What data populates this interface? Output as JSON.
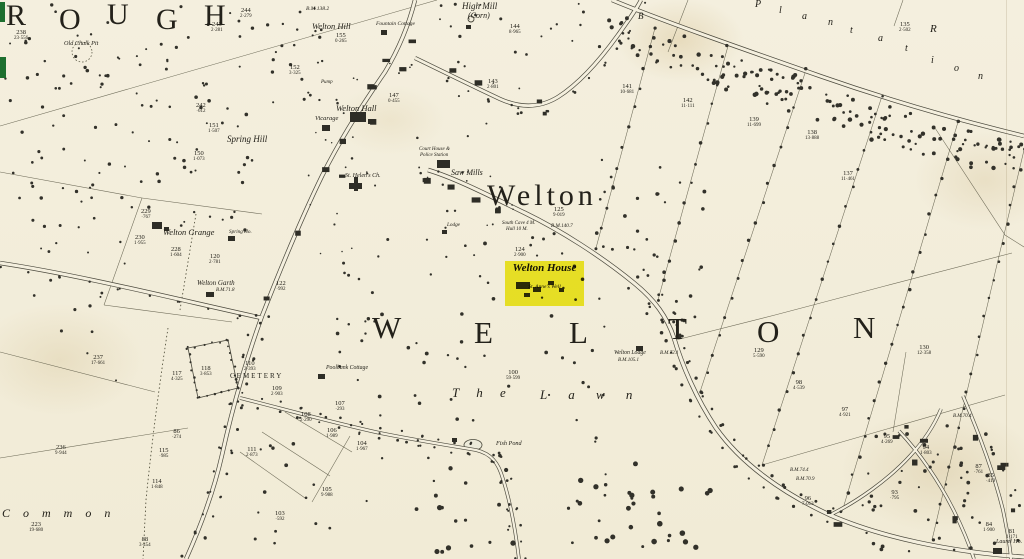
{
  "map": {
    "colors": {
      "paper": "#f4efde",
      "ink": "#4a483c",
      "text": "#23211a",
      "highlight": "#f2ef2b",
      "green_mark": "#1d6f2f"
    },
    "highlight": {
      "title": "Welton House",
      "subtitle": "St. Anne's Well"
    },
    "labels": [
      {
        "t": "R",
        "x": 6,
        "y": 1,
        "fs": 30
      },
      {
        "t": "O",
        "x": 59,
        "y": 5,
        "fs": 30
      },
      {
        "t": "U",
        "x": 107,
        "y": 0,
        "fs": 30
      },
      {
        "t": "G",
        "x": 156,
        "y": 5,
        "fs": 30
      },
      {
        "t": "H",
        "x": 204,
        "y": 1,
        "fs": 30
      },
      {
        "t": "Welton",
        "x": 487,
        "y": 181,
        "fs": 30,
        "ls": 4
      },
      {
        "t": "W",
        "x": 372,
        "y": 312,
        "fs": 31
      },
      {
        "t": "E",
        "x": 474,
        "y": 317,
        "fs": 31
      },
      {
        "t": "L",
        "x": 569,
        "y": 317,
        "fs": 31
      },
      {
        "t": "T",
        "x": 668,
        "y": 313,
        "fs": 31
      },
      {
        "t": "O",
        "x": 757,
        "y": 316,
        "fs": 31
      },
      {
        "t": "N",
        "x": 853,
        "y": 312,
        "fs": 31
      },
      {
        "t": "T h e",
        "x": 452,
        "y": 386,
        "fs": 13,
        "it": 1,
        "ls": 7
      },
      {
        "t": "L a w n",
        "x": 540,
        "y": 388,
        "fs": 13,
        "it": 1,
        "ls": 9
      },
      {
        "t": "C o m m o n",
        "x": 2,
        "y": 507,
        "fs": 12,
        "it": 1,
        "ls": 5
      },
      {
        "t": "P",
        "x": 755,
        "y": 0,
        "fs": 10,
        "it": 1
      },
      {
        "t": "l",
        "x": 779,
        "y": 6,
        "fs": 10,
        "it": 1
      },
      {
        "t": "a",
        "x": 802,
        "y": 12,
        "fs": 10,
        "it": 1
      },
      {
        "t": "n",
        "x": 828,
        "y": 18,
        "fs": 10,
        "it": 1
      },
      {
        "t": "t",
        "x": 850,
        "y": 26,
        "fs": 10,
        "it": 1
      },
      {
        "t": "a",
        "x": 878,
        "y": 34,
        "fs": 10,
        "it": 1
      },
      {
        "t": "t",
        "x": 905,
        "y": 44,
        "fs": 10,
        "it": 1
      },
      {
        "t": "i",
        "x": 931,
        "y": 56,
        "fs": 10,
        "it": 1
      },
      {
        "t": "o",
        "x": 954,
        "y": 64,
        "fs": 10,
        "it": 1
      },
      {
        "t": "n",
        "x": 978,
        "y": 72,
        "fs": 10,
        "it": 1
      },
      {
        "t": "B",
        "x": 638,
        "y": 12,
        "fs": 9,
        "it": 1
      },
      {
        "t": "R",
        "x": 930,
        "y": 24,
        "fs": 11,
        "it": 1
      },
      {
        "t": "High Mill",
        "x": 462,
        "y": 2,
        "fs": 9,
        "it": 1
      },
      {
        "t": "(Corn)",
        "x": 468,
        "y": 12,
        "fs": 8,
        "it": 1
      },
      {
        "t": "Fountain Cottage",
        "x": 376,
        "y": 22,
        "fs": 5.5,
        "it": 1
      },
      {
        "t": "Welton Hill",
        "x": 312,
        "y": 22,
        "fs": 8.5,
        "it": 1
      },
      {
        "t": "B.M.138.2",
        "x": 306,
        "y": 7,
        "fs": 5.5,
        "it": 1
      },
      {
        "t": "Welton Hall",
        "x": 336,
        "y": 104,
        "fs": 8.5,
        "it": 1
      },
      {
        "t": "Vicarage",
        "x": 315,
        "y": 116,
        "fs": 6.5,
        "it": 1
      },
      {
        "t": "Spring Hill",
        "x": 227,
        "y": 135,
        "fs": 9,
        "it": 1
      },
      {
        "t": "Pump",
        "x": 321,
        "y": 80,
        "fs": 5,
        "it": 1
      },
      {
        "t": "Saw Mills",
        "x": 451,
        "y": 169,
        "fs": 8,
        "it": 1
      },
      {
        "t": "St. Helen's Ch.",
        "x": 345,
        "y": 173,
        "fs": 6,
        "it": 1
      },
      {
        "t": "Court House &",
        "x": 419,
        "y": 147,
        "fs": 5,
        "it": 1
      },
      {
        "t": "Police Station",
        "x": 420,
        "y": 153,
        "fs": 5,
        "it": 1
      },
      {
        "t": "Welton Grange",
        "x": 163,
        "y": 228,
        "fs": 8.5,
        "it": 1
      },
      {
        "t": "Spring Ho.",
        "x": 229,
        "y": 230,
        "fs": 5.2,
        "it": 1
      },
      {
        "t": "Welton Garth",
        "x": 197,
        "y": 280,
        "fs": 7,
        "it": 1
      },
      {
        "t": "B.M.71.8",
        "x": 216,
        "y": 288,
        "fs": 5,
        "it": 1
      },
      {
        "t": "CEMETERY",
        "x": 230,
        "y": 373,
        "fs": 7,
        "ls": 2
      },
      {
        "t": "Poolbank Cottage",
        "x": 326,
        "y": 366,
        "fs": 5.8,
        "it": 1
      },
      {
        "t": "Fish Pond",
        "x": 496,
        "y": 441,
        "fs": 6.2,
        "it": 1
      },
      {
        "t": "Welton Lodge",
        "x": 614,
        "y": 351,
        "fs": 5.8,
        "it": 1
      },
      {
        "t": "B.M.105.1",
        "x": 618,
        "y": 358,
        "fs": 5,
        "it": 1
      },
      {
        "t": "Old Chalk Pit",
        "x": 64,
        "y": 41,
        "fs": 6.2,
        "it": 1
      },
      {
        "t": "South Cave 4 M.",
        "x": 502,
        "y": 221,
        "fs": 5,
        "it": 1
      },
      {
        "t": "Hull 10 M.",
        "x": 506,
        "y": 227,
        "fs": 5,
        "it": 1
      },
      {
        "t": "B.M.140.7",
        "x": 551,
        "y": 224,
        "fs": 5.2,
        "it": 1
      },
      {
        "t": "B.M.72.1",
        "x": 660,
        "y": 351,
        "fs": 5,
        "it": 1
      },
      {
        "t": "B.M.74.4",
        "x": 790,
        "y": 468,
        "fs": 5,
        "it": 1
      },
      {
        "t": "B.M.70.9",
        "x": 796,
        "y": 477,
        "fs": 5,
        "it": 1
      },
      {
        "t": "B.M.70.4",
        "x": 953,
        "y": 414,
        "fs": 5,
        "it": 1
      },
      {
        "t": "Laurel Ho.",
        "x": 996,
        "y": 539,
        "fs": 6,
        "it": 1
      },
      {
        "t": "Lodge",
        "x": 447,
        "y": 223,
        "fs": 5.2,
        "it": 1
      }
    ],
    "parcel_numbers": [
      {
        "n": "238",
        "a": "23·556",
        "x": 14,
        "y": 29
      },
      {
        "n": "244",
        "a": "2·279",
        "x": 240,
        "y": 7
      },
      {
        "n": "243",
        "a": "2·281",
        "x": 211,
        "y": 21
      },
      {
        "n": "242",
        "a": "·612",
        "x": 196,
        "y": 102
      },
      {
        "n": "151",
        "a": "1·507",
        "x": 208,
        "y": 122
      },
      {
        "n": "150",
        "a": "1·073",
        "x": 193,
        "y": 150
      },
      {
        "n": "155",
        "a": "0·265",
        "x": 335,
        "y": 32
      },
      {
        "n": "152",
        "a": "3·325",
        "x": 289,
        "y": 64
      },
      {
        "n": "147",
        "a": "0·455",
        "x": 388,
        "y": 92
      },
      {
        "n": "144",
        "a": "8·965",
        "x": 509,
        "y": 23
      },
      {
        "n": "143",
        "a": "2·801",
        "x": 487,
        "y": 78
      },
      {
        "n": "141",
        "a": "10·681",
        "x": 620,
        "y": 83
      },
      {
        "n": "142",
        "a": "11·111",
        "x": 681,
        "y": 97
      },
      {
        "n": "139",
        "a": "11·699",
        "x": 747,
        "y": 116
      },
      {
        "n": "138",
        "a": "13·888",
        "x": 805,
        "y": 129
      },
      {
        "n": "137",
        "a": "11·461",
        "x": 841,
        "y": 170
      },
      {
        "n": "135",
        "a": "2·502",
        "x": 899,
        "y": 21
      },
      {
        "n": "130",
        "a": "12·358",
        "x": 917,
        "y": 344
      },
      {
        "n": "129",
        "a": "5·590",
        "x": 753,
        "y": 347
      },
      {
        "n": "125",
        "a": "9·019",
        "x": 553,
        "y": 206
      },
      {
        "n": "124",
        "a": "2·900",
        "x": 514,
        "y": 246
      },
      {
        "n": "120",
        "a": "2·781",
        "x": 209,
        "y": 253
      },
      {
        "n": "122",
        "a": "·992",
        "x": 276,
        "y": 280
      },
      {
        "n": "228",
        "a": "1·604",
        "x": 170,
        "y": 246
      },
      {
        "n": "230",
        "a": "1·955",
        "x": 134,
        "y": 234
      },
      {
        "n": "229",
        "a": "·767",
        "x": 141,
        "y": 208
      },
      {
        "n": "237",
        "a": "17·661",
        "x": 91,
        "y": 354
      },
      {
        "n": "117",
        "a": "4·325",
        "x": 171,
        "y": 370
      },
      {
        "n": "118",
        "a": "3·853",
        "x": 200,
        "y": 365
      },
      {
        "n": "110",
        "a": "2·393",
        "x": 244,
        "y": 360
      },
      {
        "n": "109",
        "a": "2·903",
        "x": 271,
        "y": 385
      },
      {
        "n": "108",
        "a": "2·290",
        "x": 300,
        "y": 411
      },
      {
        "n": "111",
        "a": "2·873",
        "x": 246,
        "y": 446
      },
      {
        "n": "107",
        "a": "·293",
        "x": 335,
        "y": 400
      },
      {
        "n": "106",
        "a": "1·989",
        "x": 326,
        "y": 427
      },
      {
        "n": "104",
        "a": "1·967",
        "x": 356,
        "y": 440
      },
      {
        "n": "105",
        "a": "9·988",
        "x": 321,
        "y": 486
      },
      {
        "n": "103",
        "a": "·592",
        "x": 275,
        "y": 510
      },
      {
        "n": "100",
        "a": "59·599",
        "x": 506,
        "y": 369
      },
      {
        "n": "236",
        "a": "9·944",
        "x": 55,
        "y": 444
      },
      {
        "n": "223",
        "a": "19·680",
        "x": 29,
        "y": 521
      },
      {
        "n": "115",
        "a": "·985",
        "x": 159,
        "y": 447
      },
      {
        "n": "114",
        "a": "1·848",
        "x": 151,
        "y": 478
      },
      {
        "n": "88",
        "a": "3·454",
        "x": 139,
        "y": 536
      },
      {
        "n": "86",
        "a": "·274",
        "x": 172,
        "y": 428
      },
      {
        "n": "98",
        "a": "4·539",
        "x": 793,
        "y": 379
      },
      {
        "n": "97",
        "a": "4·921",
        "x": 839,
        "y": 406
      },
      {
        "n": "95",
        "a": "4·269",
        "x": 881,
        "y": 433
      },
      {
        "n": "94",
        "a": "1·803",
        "x": 920,
        "y": 444
      },
      {
        "n": "93",
        "a": "·795",
        "x": 890,
        "y": 489
      },
      {
        "n": "96",
        "a": "7·013",
        "x": 802,
        "y": 495
      },
      {
        "n": "87",
        "a": "·761",
        "x": 974,
        "y": 463
      },
      {
        "n": "85",
        "a": "·419",
        "x": 986,
        "y": 472
      },
      {
        "n": "84",
        "a": "1·900",
        "x": 983,
        "y": 521
      },
      {
        "n": "81",
        "a": "1·171",
        "x": 1006,
        "y": 528
      }
    ]
  }
}
